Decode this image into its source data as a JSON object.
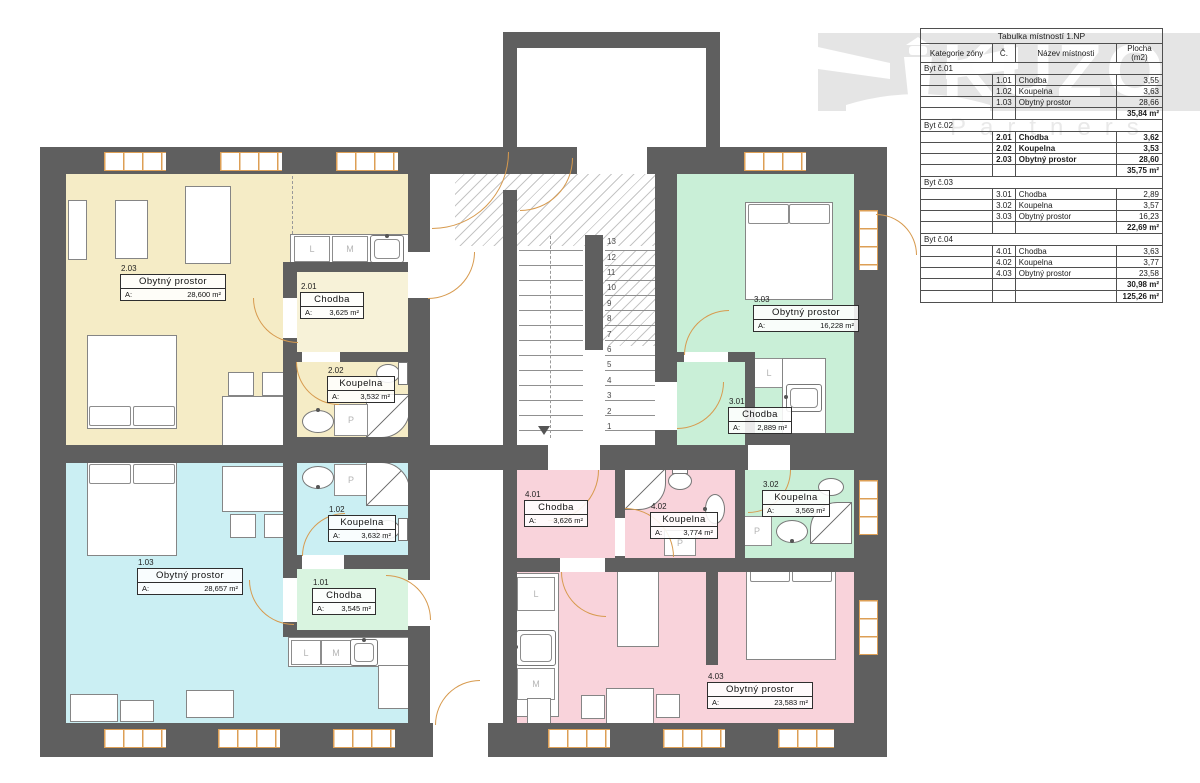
{
  "watermark": {
    "brand": "KUZO",
    "subbrand": "Partners"
  },
  "legend_table": {
    "title": "Tabulka místností 1.NP",
    "headers": [
      "Kategorie zóny",
      "Č.",
      "Název místnosti",
      "Plocha (m2)"
    ],
    "groups": [
      {
        "zone": "Byt č.01",
        "highlight": false,
        "rows": [
          [
            "1.01",
            "Chodba",
            "3,55"
          ],
          [
            "1.02",
            "Koupelna",
            "3,63"
          ],
          [
            "1.03",
            "Obytný prostor",
            "28,66"
          ]
        ],
        "subtotal": "35,84 m²"
      },
      {
        "zone": "Byt č.02",
        "highlight": true,
        "rows": [
          [
            "2.01",
            "Chodba",
            "3,62"
          ],
          [
            "2.02",
            "Koupelna",
            "3,53"
          ],
          [
            "2.03",
            "Obytný prostor",
            "28,60"
          ]
        ],
        "subtotal": "35,75 m²"
      },
      {
        "zone": "Byt č.03",
        "highlight": false,
        "rows": [
          [
            "3.01",
            "Chodba",
            "2,89"
          ],
          [
            "3.02",
            "Koupelna",
            "3,57"
          ],
          [
            "3.03",
            "Obytný prostor",
            "16,23"
          ]
        ],
        "subtotal": "22,69 m²"
      },
      {
        "zone": "Byt č.04",
        "highlight": false,
        "rows": [
          [
            "4.01",
            "Chodba",
            "3,63"
          ],
          [
            "4.02",
            "Koupelna",
            "3,77"
          ],
          [
            "4.03",
            "Obytný prostor",
            "23,58"
          ]
        ],
        "subtotal": "30,98 m²"
      }
    ],
    "total": "125,26 m²"
  },
  "rooms": [
    {
      "number": "2.03",
      "name": "Obytný prostor",
      "area_label": "A:",
      "area_value": "28,600 m²"
    },
    {
      "number": "2.01",
      "name": "Chodba",
      "area_label": "A:",
      "area_value": "3,625 m²"
    },
    {
      "number": "2.02",
      "name": "Koupelna",
      "area_label": "A:",
      "area_value": "3,532 m²"
    },
    {
      "number": "1.03",
      "name": "Obytný prostor",
      "area_label": "A:",
      "area_value": "28,657 m²"
    },
    {
      "number": "1.02",
      "name": "Koupelna",
      "area_label": "A:",
      "area_value": "3,632 m²"
    },
    {
      "number": "1.01",
      "name": "Chodba",
      "area_label": "A:",
      "area_value": "3,545 m²"
    },
    {
      "number": "3.03",
      "name": "Obytný prostor",
      "area_label": "A:",
      "area_value": "16,228 m²"
    },
    {
      "number": "3.01",
      "name": "Chodba",
      "area_label": "A:",
      "area_value": "2,889 m²"
    },
    {
      "number": "3.02",
      "name": "Koupelna",
      "area_label": "A:",
      "area_value": "3,569 m²"
    },
    {
      "number": "4.01",
      "name": "Chodba",
      "area_label": "A:",
      "area_value": "3,626 m²"
    },
    {
      "number": "4.02",
      "name": "Koupelna",
      "area_label": "A:",
      "area_value": "3,774 m²"
    },
    {
      "number": "4.03",
      "name": "Obytný prostor",
      "area_label": "A:",
      "area_value": "23,583 m²"
    }
  ],
  "appliances": {
    "washer": "P",
    "fridge": "L",
    "dishwasher": "M"
  },
  "stairs": {
    "numbers": [
      "1",
      "2",
      "3",
      "4",
      "5",
      "6",
      "7",
      "8",
      "9",
      "10",
      "11",
      "12",
      "13"
    ]
  },
  "colors": {
    "wall": "#5f5f5f",
    "byt1": "#cbeff3",
    "byt1_chodba": "#d9f4e0",
    "byt2": "#f5ecc6",
    "byt2_chodba": "#f7f2d8",
    "byt3": "#c9efd7",
    "byt4": "#f9d3db",
    "door": "#d79a4e",
    "window_frame": "#dd9f55"
  }
}
